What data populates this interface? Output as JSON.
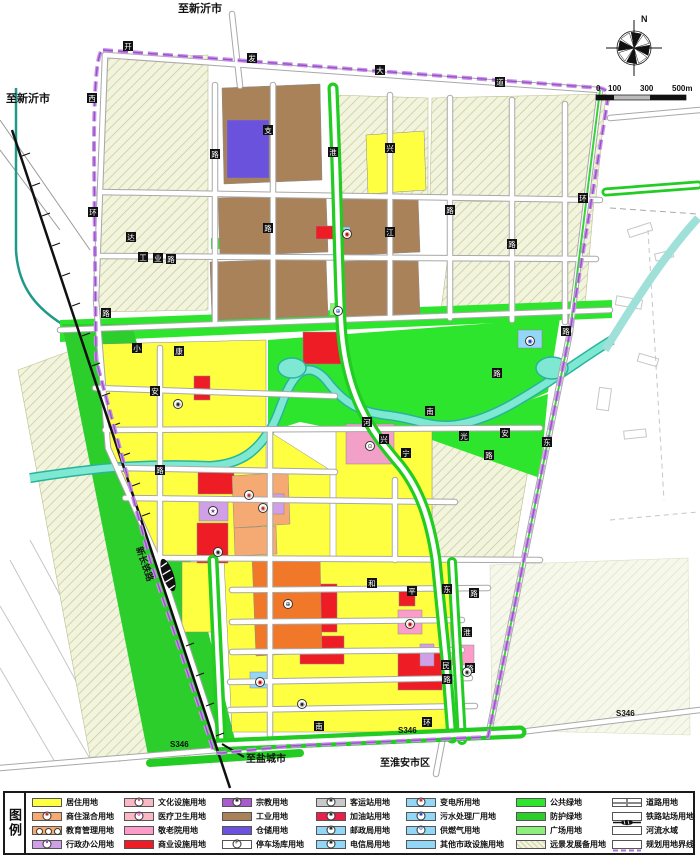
{
  "map": {
    "compass": {
      "label": "N"
    },
    "scalebar": {
      "labels": [
        "0",
        "100",
        "300",
        "500m"
      ]
    },
    "railway_label": {
      "text": "新长铁路",
      "x": 136,
      "y": 548,
      "rotate": 71
    },
    "place_labels": [
      {
        "text": "至新沂市",
        "x": 222,
        "y": 12,
        "size": 11,
        "anchor": "end"
      },
      {
        "text": "至新沂市",
        "x": 6,
        "y": 102,
        "size": 11,
        "anchor": "start"
      },
      {
        "text": "至盐城市",
        "x": 246,
        "y": 762,
        "size": 10,
        "anchor": "start"
      },
      {
        "text": "至淮安市区",
        "x": 380,
        "y": 766,
        "size": 10,
        "anchor": "start"
      },
      {
        "text": "S346",
        "x": 170,
        "y": 747,
        "size": 8,
        "anchor": "start"
      },
      {
        "text": "S346",
        "x": 398,
        "y": 733,
        "size": 8,
        "anchor": "start"
      },
      {
        "text": "S346",
        "x": 616,
        "y": 716,
        "size": 8,
        "anchor": "start"
      }
    ],
    "road_labels": [
      {
        "c": "开",
        "x": 128,
        "y": 46
      },
      {
        "c": "发",
        "x": 252,
        "y": 58
      },
      {
        "c": "大",
        "x": 380,
        "y": 70
      },
      {
        "c": "道",
        "x": 500,
        "y": 82
      },
      {
        "c": "西",
        "x": 92,
        "y": 98
      },
      {
        "c": "环",
        "x": 93,
        "y": 212
      },
      {
        "c": "路",
        "x": 106,
        "y": 313
      },
      {
        "c": "达",
        "x": 131,
        "y": 237
      },
      {
        "c": "工",
        "x": 143,
        "y": 257
      },
      {
        "c": "业",
        "x": 158,
        "y": 258
      },
      {
        "c": "路",
        "x": 171,
        "y": 259
      },
      {
        "c": "支",
        "x": 268,
        "y": 130
      },
      {
        "c": "路",
        "x": 268,
        "y": 228
      },
      {
        "c": "兴",
        "x": 390,
        "y": 148
      },
      {
        "c": "江",
        "x": 390,
        "y": 232
      },
      {
        "c": "路",
        "x": 450,
        "y": 210
      },
      {
        "c": "路",
        "x": 215,
        "y": 154
      },
      {
        "c": "路",
        "x": 512,
        "y": 244
      },
      {
        "c": "淮",
        "x": 333,
        "y": 152
      },
      {
        "c": "环",
        "x": 583,
        "y": 198
      },
      {
        "c": "路",
        "x": 566,
        "y": 331
      },
      {
        "c": "小",
        "x": 137,
        "y": 348
      },
      {
        "c": "康",
        "x": 179,
        "y": 351
      },
      {
        "c": "安",
        "x": 155,
        "y": 391
      },
      {
        "c": "路",
        "x": 160,
        "y": 470
      },
      {
        "c": "河",
        "x": 367,
        "y": 422
      },
      {
        "c": "兴",
        "x": 384,
        "y": 439
      },
      {
        "c": "光",
        "x": 464,
        "y": 436
      },
      {
        "c": "宁",
        "x": 406,
        "y": 453
      },
      {
        "c": "南",
        "x": 430,
        "y": 411
      },
      {
        "c": "安",
        "x": 505,
        "y": 433
      },
      {
        "c": "东",
        "x": 547,
        "y": 442
      },
      {
        "c": "路",
        "x": 489,
        "y": 455
      },
      {
        "c": "路",
        "x": 497,
        "y": 373
      },
      {
        "c": "和",
        "x": 372,
        "y": 583
      },
      {
        "c": "平",
        "x": 412,
        "y": 591
      },
      {
        "c": "东",
        "x": 447,
        "y": 589
      },
      {
        "c": "路",
        "x": 474,
        "y": 593
      },
      {
        "c": "民",
        "x": 446,
        "y": 665
      },
      {
        "c": "路",
        "x": 447,
        "y": 679
      },
      {
        "c": "淮",
        "x": 467,
        "y": 632
      },
      {
        "c": "路",
        "x": 470,
        "y": 668
      },
      {
        "c": "南",
        "x": 319,
        "y": 726
      },
      {
        "c": "环",
        "x": 427,
        "y": 722
      }
    ],
    "symbols": [
      {
        "g": "◉",
        "x": 249,
        "y": 495,
        "col": "#b03030"
      },
      {
        "g": "◉",
        "x": 263,
        "y": 508,
        "col": "#b03030"
      },
      {
        "g": "★",
        "x": 213,
        "y": 511,
        "col": "#7030a0"
      },
      {
        "g": "⊕",
        "x": 288,
        "y": 604,
        "col": "#222222"
      },
      {
        "g": "⊙",
        "x": 370,
        "y": 446,
        "col": "#222222"
      },
      {
        "g": "◉",
        "x": 410,
        "y": 624,
        "col": "#c00000"
      },
      {
        "g": "◉",
        "x": 530,
        "y": 341,
        "col": "#1040c0"
      },
      {
        "g": "◉",
        "x": 260,
        "y": 682,
        "col": "#c00000"
      },
      {
        "g": "⊕",
        "x": 338,
        "y": 311,
        "col": "#1040c0"
      },
      {
        "g": "◉",
        "x": 347,
        "y": 234,
        "col": "#c00000"
      },
      {
        "g": "◉",
        "x": 178,
        "y": 404,
        "col": "#222222"
      },
      {
        "g": "◉",
        "x": 302,
        "y": 704,
        "col": "#222222"
      },
      {
        "g": "◉",
        "x": 467,
        "y": 672,
        "col": "#222222"
      },
      {
        "g": "◉",
        "x": 218,
        "y": 552,
        "col": "#222222"
      }
    ],
    "colors": {
      "residential": "#ffff42",
      "mixed": "#f5a973",
      "admin": "#cf9fe8",
      "culture_pink": "#f9b8c4",
      "nursing_pink": "#fc9cc8",
      "commercial_red": "#ee1c25",
      "religion_purple": "#aa59cf",
      "industry_brown": "#a9825a",
      "warehouse_blue": "#6a52dc",
      "municipal_blue": "#93d7f7",
      "public_green": "#2ee52e",
      "protect_green": "#2bce2b",
      "plaza_green": "#8df07d",
      "reserve_beige": "#f2f4de",
      "river_cyan": "#7fe8d2",
      "boundary_purple": "#c594e2",
      "orange_block": "#f07828",
      "gas_red": "#e8204a",
      "station_gray": "#c9c9c9"
    }
  },
  "legend": {
    "title": "图例",
    "columns": [
      {
        "entries": [
          {
            "label": "居住用地",
            "type": "fill",
            "color": "#ffff42"
          },
          {
            "label": "商住混合用地",
            "type": "fill-symbol",
            "color": "#f5a973",
            "symbol": "◉",
            "symcolor": "#b03030"
          },
          {
            "label": "教育管理用地",
            "type": "symbols3",
            "color": "#f5a973"
          },
          {
            "label": "行政办公用地",
            "type": "fill-symbol",
            "color": "#cf9fe8",
            "symbol": "★",
            "symcolor": "#7030a0"
          }
        ]
      },
      {
        "entries": [
          {
            "label": "文化设施用地",
            "type": "fill-symbol",
            "color": "#f9b8c4",
            "symbol": "★",
            "symcolor": "#d03050"
          },
          {
            "label": "医疗卫生用地",
            "type": "fill-symbol",
            "color": "#f9b8c4",
            "symbol": "⊕",
            "symcolor": "#e020a0"
          },
          {
            "label": "敬老院用地",
            "type": "fill",
            "color": "#fc9cc8"
          },
          {
            "label": "商业设施用地",
            "type": "fill",
            "color": "#ee1c25"
          }
        ]
      },
      {
        "entries": [
          {
            "label": "宗教用地",
            "type": "fill-symbol",
            "color": "#aa59cf",
            "symbol": "◉",
            "symcolor": "#222222"
          },
          {
            "label": "工业用地",
            "type": "fill",
            "color": "#a9825a"
          },
          {
            "label": "仓储用地",
            "type": "fill",
            "color": "#6a52dc"
          },
          {
            "label": "停车场库用地",
            "type": "fill-symbol",
            "color": "#ffffff",
            "symbol": "P",
            "symcolor": "#222222"
          }
        ]
      },
      {
        "entries": [
          {
            "label": "客运站用地",
            "type": "fill-symbol",
            "color": "#c9c9c9",
            "symbol": "◉",
            "symcolor": "#222222"
          },
          {
            "label": "加油站用地",
            "type": "fill-symbol",
            "color": "#e8204a",
            "symbol": "◉",
            "symcolor": "#222222"
          },
          {
            "label": "邮政局用地",
            "type": "fill-symbol",
            "color": "#93d7f7",
            "symbol": "◉",
            "symcolor": "#222222"
          },
          {
            "label": "电信局用地",
            "type": "fill-symbol",
            "color": "#93d7f7",
            "symbol": "◉",
            "symcolor": "#222222"
          }
        ]
      },
      {
        "entries": [
          {
            "label": "变电所用地",
            "type": "fill-symbol",
            "color": "#93d7f7",
            "symbol": "◉",
            "symcolor": "#d02020"
          },
          {
            "label": "污水处理厂用地",
            "type": "fill-symbol",
            "color": "#93d7f7",
            "symbol": "◉",
            "symcolor": "#2040c0"
          },
          {
            "label": "供燃气用地",
            "type": "fill-symbol",
            "color": "#93d7f7",
            "symbol": "⊙",
            "symcolor": "#2040c0"
          },
          {
            "label": "其他市政设施用地",
            "type": "fill",
            "color": "#93d7f7"
          }
        ]
      },
      {
        "entries": [
          {
            "label": "公共绿地",
            "type": "fill",
            "color": "#2ee52e"
          },
          {
            "label": "防护绿地",
            "type": "fill",
            "color": "#2bce2b"
          },
          {
            "label": "广场用地",
            "type": "fill",
            "color": "#8df07d"
          },
          {
            "label": "远景发展备用地",
            "type": "hatch",
            "color": "#f2f4de"
          }
        ]
      },
      {
        "entries": [
          {
            "label": "道路用地",
            "type": "road-icon"
          },
          {
            "label": "铁路站场用地",
            "type": "rail-icon"
          },
          {
            "label": "河流水域",
            "type": "river-icon",
            "color": "#7fe8d2"
          },
          {
            "label": "规划用地界线",
            "type": "dash-icon",
            "color": "#b070d8"
          }
        ]
      }
    ]
  }
}
